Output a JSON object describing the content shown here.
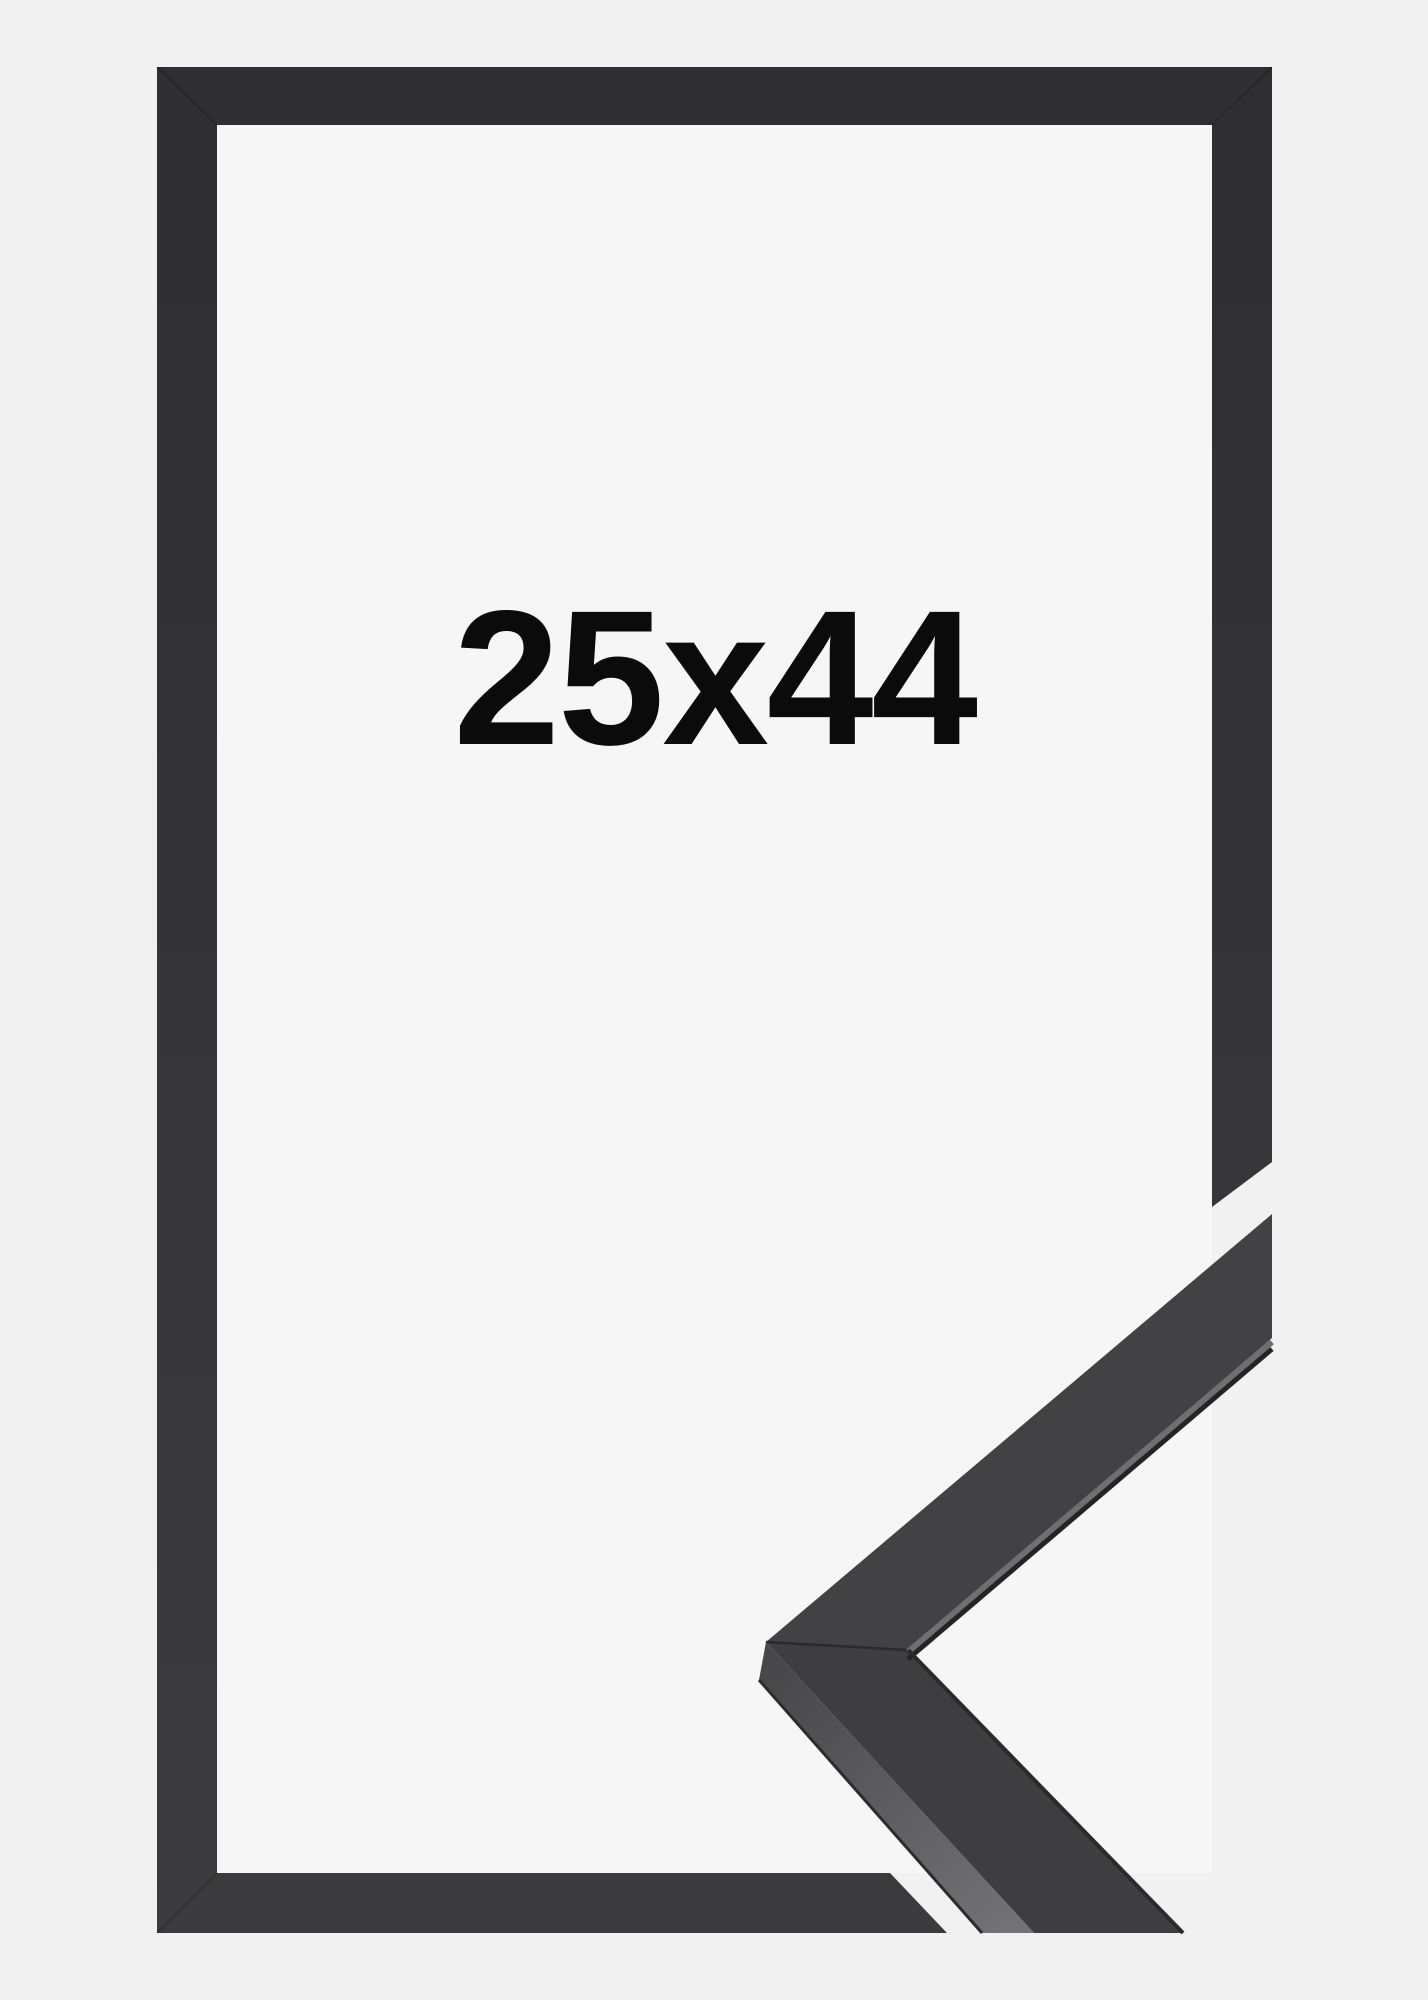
{
  "product_image": {
    "size_label": "25x44",
    "colors": {
      "background": "#f1f1f2",
      "interior": "#f6f6f7",
      "frame": "#353537",
      "frame_top": "#2f2f31",
      "frame_bottom": "#3b3b3d",
      "sample_face_upper": "#424244",
      "sample_face_lower": "#3e3e40",
      "sample_edge_light": "#6f6f72",
      "sample_edge_dark": "#242426",
      "label_text": "#0b0b0b"
    }
  }
}
